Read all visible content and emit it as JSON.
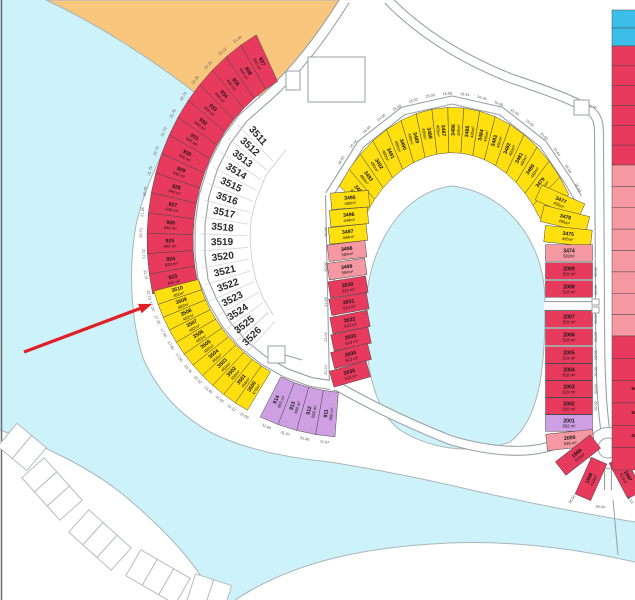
{
  "map": {
    "colors": {
      "red": "#e73a5c",
      "yellow": "#ffdf0e",
      "purple": "#cf9fe4",
      "pink": "#f598a2",
      "cyanPlot": "#3bbfe8",
      "water": "#cdf2fa",
      "sand": "#f9c67e",
      "roadLine": "#9aa0a4",
      "plotStroke": "#4a4a4a",
      "shore": "#a9b6ba",
      "dimText": "#555555",
      "whiteNum": "#2b2b2b",
      "arrow": "#e01f26",
      "beachLine": "#b8bcbe"
    },
    "arcs": [
      {
        "id": "outer-red",
        "cx": 350,
        "cy": 240,
        "rx": 180,
        "ry": 205,
        "band": 23,
        "a0": 240,
        "step": -5.07,
        "dimScale": 1.155,
        "plots": [
          {
            "n": "937",
            "a": "640 m²",
            "c": "red"
          },
          {
            "n": "936",
            "a": "640 m²",
            "c": "red"
          },
          {
            "n": "935",
            "a": "640 m²",
            "c": "red"
          },
          {
            "n": "934",
            "a": "640 m²",
            "c": "red"
          },
          {
            "n": "933",
            "a": "640 m²",
            "c": "red"
          },
          {
            "n": "932",
            "a": "640 m²",
            "c": "red"
          },
          {
            "n": "931",
            "a": "640 m²",
            "c": "red"
          },
          {
            "n": "930",
            "a": "640 m²",
            "c": "red"
          },
          {
            "n": "929",
            "a": "640 m²",
            "c": "red"
          },
          {
            "n": "928",
            "a": "640 m²",
            "c": "red"
          },
          {
            "n": "927",
            "a": "640 m²",
            "c": "red"
          },
          {
            "n": "926",
            "a": "640 m²",
            "c": "red"
          },
          {
            "n": "925",
            "a": "640 m²",
            "c": "red"
          },
          {
            "n": "924",
            "a": "628 m²",
            "c": "red"
          },
          {
            "n": "923",
            "a": "645 m²",
            "c": "red"
          }
        ],
        "dims": [
          "21.36",
          "22.02",
          "22.25",
          "22.25",
          "22.75",
          "22.75",
          "21.73",
          "22.73",
          "21.75",
          "20.75",
          "21.36",
          "20.73",
          "22.73",
          "21.73",
          "22.73"
        ]
      },
      {
        "id": "outer-yellow",
        "cx": 350,
        "cy": 240,
        "rx": 180,
        "ry": 175,
        "band": 23,
        "a0": 163,
        "step": -4.06,
        "dimScale": 1.17,
        "plots": [
          {
            "n": "3510",
            "a": "482m²",
            "c": "yellow"
          },
          {
            "n": "3509",
            "a": "482m²",
            "c": "yellow"
          },
          {
            "n": "3508",
            "a": "482m²",
            "c": "yellow"
          },
          {
            "n": "3507",
            "a": "482m²",
            "c": "yellow"
          },
          {
            "n": "3506",
            "a": "482m²",
            "c": "yellow"
          },
          {
            "n": "3505",
            "a": "482m²",
            "c": "yellow"
          },
          {
            "n": "3504",
            "a": "456m²",
            "c": "yellow"
          },
          {
            "n": "3503",
            "a": "456m²",
            "c": "yellow"
          },
          {
            "n": "3502",
            "a": "456m²",
            "c": "yellow"
          },
          {
            "n": "3501",
            "a": "456m²",
            "c": "yellow"
          },
          {
            "n": "3500",
            "a": "476m²",
            "c": "yellow"
          }
        ],
        "dims": [
          "17.20",
          "17.35",
          "17.50",
          "17.65",
          "17.50",
          "15.75",
          "15.12",
          "13.46",
          "15.00",
          "15.12",
          "15.00"
        ]
      },
      {
        "id": "outer-purple",
        "cx": 350,
        "cy": 240,
        "rx": 180,
        "ry": 175,
        "band": 23,
        "a0": 113.5,
        "step": -5.5,
        "dimScale": 1.17,
        "dimsAtCenter": true,
        "plots": [
          {
            "n": "914",
            "a": "660 m²",
            "c": "purple"
          },
          {
            "n": "913",
            "a": "660 m²",
            "c": "purple"
          },
          {
            "n": "912",
            "a": "660 m²",
            "c": "purple"
          },
          {
            "n": "911",
            "a": "660 m²",
            "c": "purple"
          }
        ],
        "dims": [
          "31.90",
          "31.97",
          "31.96",
          "31.97"
        ]
      },
      {
        "id": "lagoon-arc",
        "cx": 452,
        "cy": 290,
        "rx": 120,
        "ry": 160,
        "band": 17,
        "a0": 218,
        "step": 6.7,
        "dimScale": 1.22,
        "plots": [
          {
            "n": "3494",
            "a": "480m²",
            "c": "yellow"
          },
          {
            "n": "3493",
            "a": "480m²",
            "c": "yellow"
          },
          {
            "n": "3492",
            "a": "480m²",
            "c": "yellow"
          },
          {
            "n": "3491",
            "a": "480m²",
            "c": "yellow"
          },
          {
            "n": "3490",
            "a": "480m²",
            "c": "yellow"
          },
          {
            "n": "3489",
            "a": "480m²",
            "c": "yellow"
          },
          {
            "n": "3488",
            "a": "485m²",
            "c": "yellow"
          },
          {
            "n": "3487",
            "a": "485m²",
            "c": "yellow"
          },
          {
            "n": "3486",
            "a": "485m²",
            "c": "yellow"
          },
          {
            "n": "3485",
            "a": "485m²",
            "c": "yellow"
          },
          {
            "n": "3484",
            "a": "485m²",
            "c": "yellow"
          },
          {
            "n": "3483",
            "a": "480m²",
            "c": "yellow"
          },
          {
            "n": "3482",
            "a": "480m²",
            "c": "yellow"
          },
          {
            "n": "3481",
            "a": "480m²",
            "c": "yellow"
          },
          {
            "n": "3480",
            "a": "480m²",
            "c": "yellow"
          },
          {
            "n": "3479",
            "a": "495m²",
            "c": "yellow"
          },
          {
            "n": "3478",
            "a": "495m²",
            "c": "yellow"
          }
        ],
        "dims": [
          "16.03",
          "16.44",
          "16.44",
          "15.00",
          "15.00",
          "15.02",
          "15.00",
          "15.00",
          "16.44",
          "16.44",
          "15.00",
          "15.00",
          "15.02",
          "15.00",
          "16.44",
          "16.44",
          "18.03"
        ]
      }
    ],
    "columns": [
      {
        "id": "west-column",
        "w": 38,
        "h": 16.5,
        "plots": [
          {
            "n": "3495",
            "a": "480m²",
            "c": "yellow",
            "x": 350,
            "y": 200,
            "rot": -4
          },
          {
            "n": "3496",
            "a": "444m²",
            "c": "yellow",
            "x": 349,
            "y": 217,
            "rot": -5
          },
          {
            "n": "3497",
            "a": "444m²",
            "c": "yellow",
            "x": 348,
            "y": 234,
            "rot": -6
          },
          {
            "n": "3498",
            "a": "504m²",
            "c": "pink",
            "x": 347,
            "y": 251,
            "rot": -7
          },
          {
            "n": "3499",
            "a": "504m²",
            "c": "pink",
            "x": 347,
            "y": 269,
            "rot": -8
          },
          {
            "n": "2030",
            "a": "612 m²",
            "c": "red",
            "x": 348,
            "y": 287,
            "rot": -9
          },
          {
            "n": "2031",
            "a": "613 m²",
            "c": "red",
            "x": 349,
            "y": 304,
            "rot": -10
          },
          {
            "n": "2032",
            "a": "613 m²",
            "c": "red",
            "x": 350,
            "y": 322,
            "rot": -11
          },
          {
            "n": "2033",
            "a": "613 m²",
            "c": "red",
            "x": 351,
            "y": 339,
            "rot": -12
          },
          {
            "n": "2034",
            "a": "613 m²",
            "c": "red",
            "x": 351,
            "y": 356,
            "rot": -14
          },
          {
            "n": "2035",
            "a": "613 m²",
            "c": "red",
            "x": 350,
            "y": 374,
            "rot": -16
          }
        ],
        "dims": [
          {
            "t": "20.06",
            "x": 327,
            "y": 232
          },
          {
            "t": "20.00",
            "x": 327,
            "y": 267
          },
          {
            "t": "21.99",
            "x": 327,
            "y": 302
          },
          {
            "t": "22.04",
            "x": 327,
            "y": 337
          },
          {
            "t": "20.24",
            "x": 327,
            "y": 370
          }
        ]
      },
      {
        "id": "east-column",
        "w": 47,
        "h": 16.5,
        "plots": [
          {
            "n": "3477",
            "a": "495m²",
            "c": "yellow",
            "x": 560,
            "y": 202,
            "rot": 24
          },
          {
            "n": "3476",
            "a": "495m²",
            "c": "yellow",
            "x": 565,
            "y": 219,
            "rot": 14
          },
          {
            "n": "3475",
            "a": "495m²",
            "c": "yellow",
            "x": 568,
            "y": 236,
            "rot": 6
          },
          {
            "n": "3474",
            "a": "502m²",
            "c": "pink",
            "x": 569,
            "y": 253,
            "rot": 0
          },
          {
            "n": "2009",
            "a": "619 m²",
            "c": "red",
            "x": 569,
            "y": 271,
            "rot": 0
          },
          {
            "n": "2008",
            "a": "619 m²",
            "c": "red",
            "x": 569,
            "y": 289,
            "rot": 0
          },
          {
            "n": "2007",
            "a": "619 m²",
            "c": "red",
            "x": 569,
            "y": 319,
            "rot": 0
          },
          {
            "n": "2006",
            "a": "619 m²",
            "c": "red",
            "x": 569,
            "y": 337,
            "rot": 0
          },
          {
            "n": "2005",
            "a": "619 m²",
            "c": "red",
            "x": 569,
            "y": 355,
            "rot": 0
          },
          {
            "n": "2004",
            "a": "619 m²",
            "c": "red",
            "x": 569,
            "y": 372,
            "rot": 0
          },
          {
            "n": "2003",
            "a": "619 m²",
            "c": "red",
            "x": 569,
            "y": 389,
            "rot": 0
          },
          {
            "n": "2002",
            "a": "619 m²",
            "c": "red",
            "x": 569,
            "y": 406,
            "rot": 0
          },
          {
            "n": "2001",
            "a": "692 m²",
            "c": "purple",
            "x": 569,
            "y": 423,
            "rot": 0
          },
          {
            "n": "2000",
            "a": "546 m²",
            "c": "pink",
            "x": 570,
            "y": 440,
            "rot": -6
          }
        ],
        "dims": [
          {
            "t": "20.00",
            "x": 597,
            "y": 272
          },
          {
            "t": "20.00",
            "x": 597,
            "y": 290
          },
          {
            "t": "20.00",
            "x": 597,
            "y": 319
          },
          {
            "t": "20.00",
            "x": 597,
            "y": 337
          },
          {
            "t": "20.00",
            "x": 597,
            "y": 355
          },
          {
            "t": "20.00",
            "x": 597,
            "y": 372
          },
          {
            "t": "20.00",
            "x": 597,
            "y": 389
          },
          {
            "t": "20.00",
            "x": 597,
            "y": 406
          }
        ]
      }
    ],
    "white_arc": {
      "cx": 350,
      "cy": 240,
      "rx": 128,
      "ry": 150,
      "a0": 224,
      "step": -5.6,
      "numbers": [
        "3511",
        "3512",
        "3513",
        "3514",
        "3515",
        "3516",
        "3517",
        "3518",
        "3519",
        "3520",
        "3521",
        "3522",
        "3523",
        "3524",
        "3525",
        "3526"
      ]
    },
    "culdesac": {
      "cx": 608,
      "cy": 448,
      "rOuter": 20.5,
      "rInner": 10,
      "plots": [
        {
          "n": "1999",
          "a": "619m²",
          "c": "red",
          "x": 578,
          "y": 455,
          "rot": -38,
          "w": 44,
          "h": 17
        },
        {
          "n": "1998",
          "a": "610m²",
          "c": "red",
          "x": 591,
          "y": 479,
          "rot": -66,
          "w": 40,
          "h": 17
        },
        {
          "n": "1997",
          "a": "613m²",
          "c": "red",
          "x": 626,
          "y": 477,
          "rot": 62,
          "w": 40,
          "h": 17
        }
      ],
      "dims": [
        {
          "t": "36.50",
          "x": 573,
          "y": 500,
          "rot": -55
        },
        {
          "t": "38.04",
          "x": 600,
          "y": 508,
          "rot": 5
        },
        {
          "t": "36.52",
          "x": 629,
          "y": 500,
          "rot": 55
        }
      ]
    },
    "edge_strip": {
      "x": 612,
      "w": 23,
      "groups": [
        {
          "color": "cyanPlot",
          "from": 10,
          "to": 46,
          "n": 2
        },
        {
          "color": "red",
          "from": 46,
          "to": 165,
          "n": 6
        },
        {
          "color": "pink",
          "from": 165,
          "to": 336,
          "n": 8
        },
        {
          "color": "red",
          "from": 336,
          "to": 470,
          "n": 6
        }
      ],
      "fragments": [
        {
          "y": 390,
          "t": "64"
        },
        {
          "y": 414,
          "t": "54"
        },
        {
          "y": 437,
          "t": "62"
        }
      ]
    },
    "beach_clusters": [
      {
        "x": 22,
        "y": 447,
        "rot": 40,
        "n": 2
      },
      {
        "x": 52,
        "y": 489,
        "rot": 48,
        "n": 3
      },
      {
        "x": 100,
        "y": 540,
        "rot": 42,
        "n": 3
      },
      {
        "x": 158,
        "y": 577,
        "rot": 30,
        "n": 3
      },
      {
        "x": 209,
        "y": 594,
        "rot": 18,
        "n": 2
      }
    ],
    "arrow": {
      "x1": 24,
      "y1": 352,
      "x2": 152,
      "y2": 304
    },
    "structures": {
      "rects": [
        {
          "x": 308,
          "y": 57,
          "w": 57,
          "h": 45
        },
        {
          "x": 286,
          "y": 71,
          "w": 14,
          "h": 19
        },
        {
          "x": 268,
          "y": 346,
          "w": 17,
          "h": 17
        },
        {
          "x": 574,
          "y": 100,
          "w": 15,
          "h": 15
        },
        {
          "x": 592,
          "y": 299,
          "w": 7,
          "h": 6
        },
        {
          "x": 592,
          "y": 307,
          "w": 7,
          "h": 6
        }
      ],
      "lines": [
        [
          285,
          355,
          302,
          360
        ],
        [
          589,
          107,
          597,
          107
        ],
        [
          613,
          500,
          618,
          555
        ]
      ]
    }
  }
}
